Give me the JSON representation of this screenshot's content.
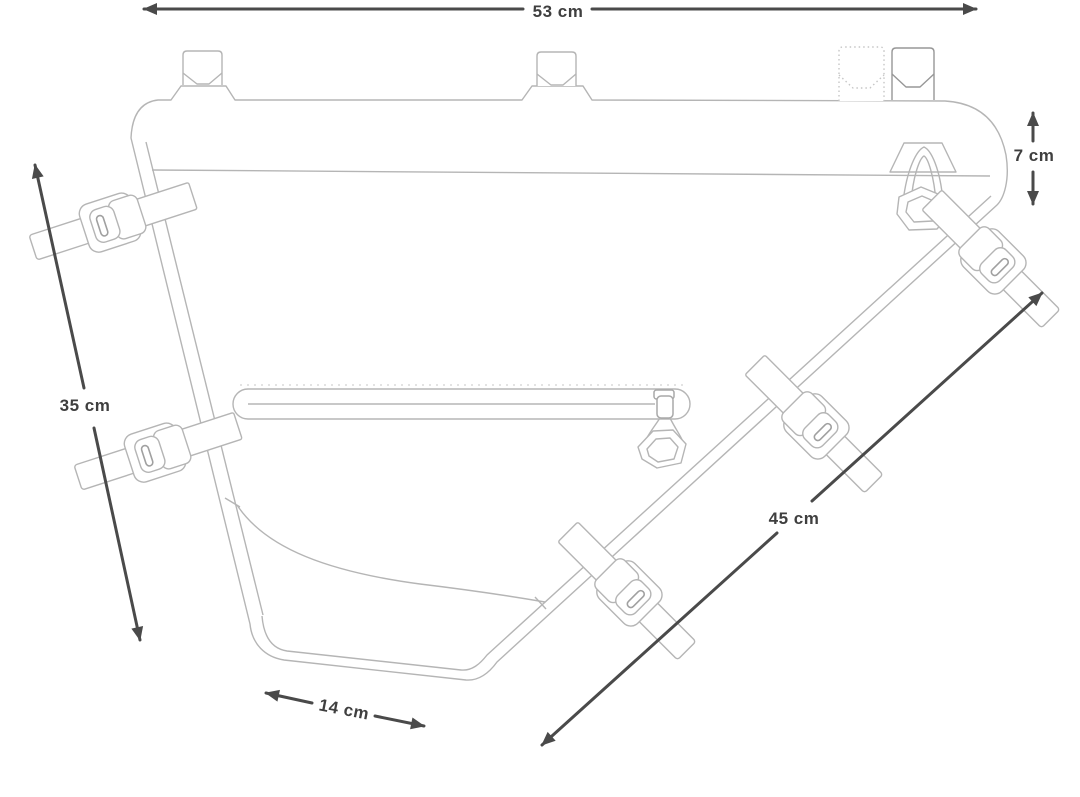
{
  "diagram": {
    "subject": "frame-bag-dimension-drawing",
    "dimensions": {
      "top_width": {
        "label": "53 cm"
      },
      "rear_height": {
        "label": "7 cm"
      },
      "front_height": {
        "label": "35 cm"
      },
      "hypotenuse": {
        "label": "45 cm"
      },
      "bottom": {
        "label": "14 cm"
      }
    },
    "colors": {
      "bag_line": "#b5b5b5",
      "dimension_line": "#4a4a4a",
      "label_text": "#3f3f3f",
      "background": "#ffffff"
    }
  }
}
